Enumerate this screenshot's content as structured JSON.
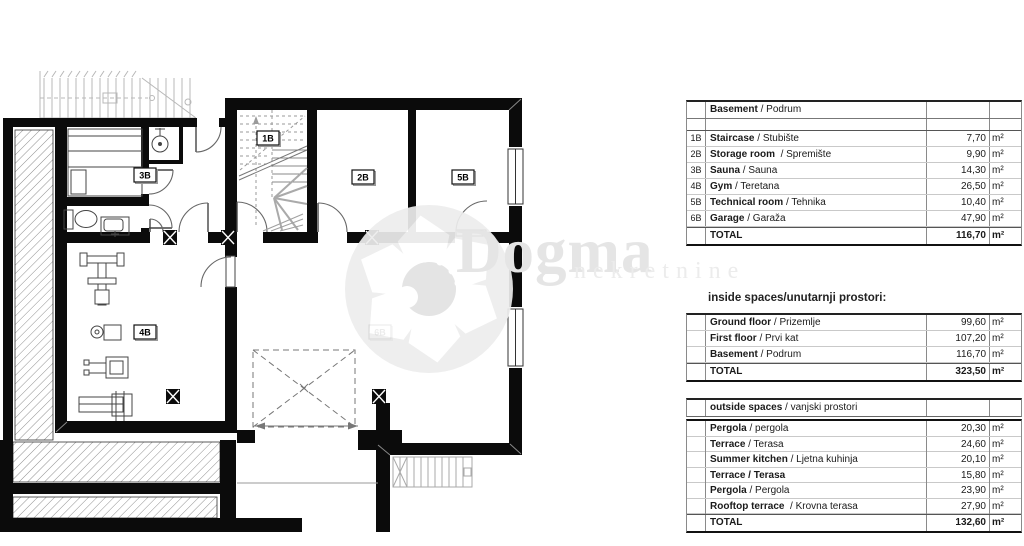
{
  "watermark": {
    "brand": "Dogma",
    "sub": "nekretnine",
    "color": "#e5e5e5"
  },
  "floor_plan": {
    "room_labels": [
      {
        "code": "1B"
      },
      {
        "code": "3B"
      },
      {
        "code": "2B"
      },
      {
        "code": "5B"
      },
      {
        "code": "4B"
      },
      {
        "code": "6B"
      }
    ]
  },
  "tables": {
    "basement": {
      "title_bold": "Basement",
      "title_rest": " / Podrum",
      "rows": [
        {
          "code": "1B",
          "name": "Staircase",
          "alt": " / Stubište",
          "value": "7,70",
          "unit": "m²"
        },
        {
          "code": "2B",
          "name": "Storage room",
          "alt": "  / Spremište",
          "value": "9,90",
          "unit": "m²"
        },
        {
          "code": "3B",
          "name": "Sauna",
          "alt": " / Sauna",
          "value": "14,30",
          "unit": "m²"
        },
        {
          "code": "4B",
          "name": "Gym",
          "alt": " / Teretana",
          "value": "26,50",
          "unit": "m²"
        },
        {
          "code": "5B",
          "name": "Technical room",
          "alt": " / Tehnika",
          "value": "10,40",
          "unit": "m²"
        },
        {
          "code": "6B",
          "name": "Garage",
          "alt": " / Garaža",
          "value": "47,90",
          "unit": "m²"
        }
      ],
      "total_label": "TOTAL",
      "total_value": "116,70",
      "total_unit": "m²"
    },
    "inside": {
      "title": "inside spaces/unutarnji prostori:",
      "rows": [
        {
          "name": "Ground floor",
          "alt": " / Prizemlje",
          "value": "99,60",
          "unit": "m²"
        },
        {
          "name": "First floor",
          "alt": " / Prvi kat",
          "value": "107,20",
          "unit": "m²"
        },
        {
          "name": "Basement",
          "alt": " / Podrum",
          "value": "116,70",
          "unit": "m²"
        }
      ],
      "total_label": "TOTAL",
      "total_value": "323,50",
      "total_unit": "m²"
    },
    "outside": {
      "title_bold": "outside spaces",
      "title_rest": " / vanjski prostori",
      "rows": [
        {
          "name": "Pergola",
          "alt": " / pergola",
          "value": "20,30",
          "unit": "m²"
        },
        {
          "name": "Terrace",
          "alt": " / Terasa",
          "value": "24,60",
          "unit": "m²"
        },
        {
          "name": "Summer kitchen",
          "alt": " / Ljetna kuhinja",
          "value": "20,10",
          "unit": "m²"
        },
        {
          "name": "Terrace / Terasa",
          "alt": "",
          "value": "15,80",
          "unit": "m²"
        },
        {
          "name": "Pergola",
          "alt": " / Pergola",
          "value": "23,90",
          "unit": "m²"
        },
        {
          "name": "Rooftop terrace",
          "alt": "  / Krovna terasa",
          "value": "27,90",
          "unit": "m²"
        }
      ],
      "total_label": "TOTAL",
      "total_value": "132,60",
      "total_unit": "m²"
    }
  }
}
